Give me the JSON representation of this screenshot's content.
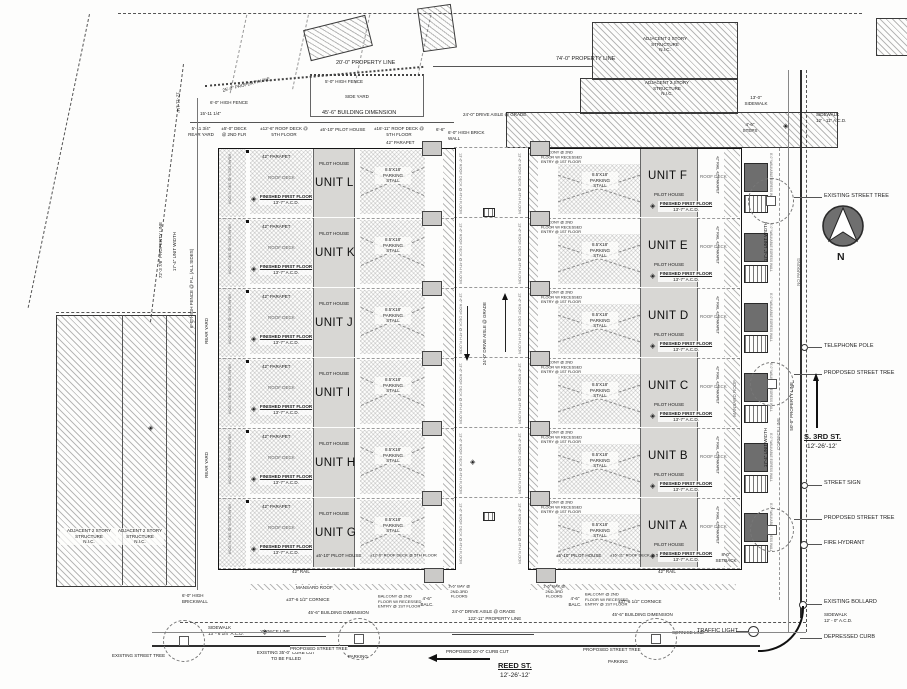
{
  "plan": {
    "sym": {
      "marker": "◈"
    },
    "compass": {
      "label": "N"
    },
    "streets": {
      "reed": {
        "name": "REED ST.",
        "lanes": "12'-26'-12'"
      },
      "third": {
        "name": "S. 3RD ST.",
        "lanes": "12'-26'-12'"
      }
    },
    "west_units": [
      "UNIT L",
      "UNIT K",
      "UNIT J",
      "UNIT I",
      "UNIT H",
      "UNIT G"
    ],
    "east_units": [
      "UNIT F",
      "UNIT E",
      "UNIT D",
      "UNIT C",
      "UNIT B",
      "UNIT A"
    ],
    "ua": {
      "parapet": "42\" PARAPET",
      "roof_deck": "ROOF DECK",
      "pilot_house": "PILOT HOUSE",
      "fff1": "FINISHED FIRST FLOOR",
      "fff2": "13'-7\" A.C.D.",
      "stall": "8.5'X18'\nPARKING\nSTALL",
      "balcony3": "BALCONY @ 2ND\nFLOOR W/ RECESSED\nENTRY @ 1ST FLOOR",
      "rail": "42\" RAIL",
      "rail_parapet": "42\" RAIL  42\" PARAPET",
      "rear_deck": "REAR DECK @ 2ND FLOOR",
      "roof_deck_4th": "13'-6\" ROOF DECK @ 4TH FLOOR",
      "egress": "8'-0\" WALKABLE EGRESS WALL"
    },
    "ann": {
      "prop_20": "20'-0\" PROPERTY LINE",
      "prop_74": "74'-0\" PROPERTY LINE",
      "prop_25": "25'-0\" PROPERTY LINE",
      "prop_72": "72'-3 7/8\" PROPERTY LINE",
      "prop_122": "122'-11\" PROPERTY LINE",
      "prop_50": "50'-0\" PROPERTY LINE",
      "prop_12": "12'-11 1/4\"",
      "fence_5": "5'-0\" HIGH FENCE",
      "fence_6": "6'-0\" HIGH FENCE",
      "fence_pl": "6'-0\" HIGH FENCE @ P.L. (ALL SIDES)",
      "side_yard": "SIDE YARD",
      "rear_yard": "REAR YARD",
      "dim_15": "15'-11 1/4\"",
      "dim_66": "6'-6\"",
      "bldg_dim": "45'-6\" BUILDING DIMENSION",
      "drive_aisle": "24'-0\" DRIVE AISLE @ GRADE",
      "rear_yard_dim": "5'-11 3/4\"\nREAR YARD",
      "deck_2nd": "±5'-0\" DECK\n@ 2ND FLR",
      "roofdeck_12": "±12'-6\" ROOF DECK @\n5TH FLOOR",
      "pilot_5": "±5'-10\" PILOT HOUSE",
      "roofdeck_16": "±16'-11\" ROOF DECK @\n5TH FLOOR",
      "brick_wall": "6'-0\" HIGH BRICK\nWALL",
      "brickwall2": "6'-0\" HIGH\nBRICKWALL",
      "sidewalk_13": "13'-0\"\nSIDEWALK",
      "sidewalk_12_11": "SIDEWALK\n12' - 11\" A.C.D.",
      "sidewalk_12_0": "SIDEWALK\n12' - 0\" A.C.D.",
      "sidewalk_13_6": "SIDEWALK\n13' - 6 1/4\" A.C.D.",
      "steps_46": "4'-6\"\nSTEPS",
      "existing_tree": "EXISTING STREET TREE",
      "proposed_tree": "PROPOSED STREET TREE",
      "telephone_pole": "TELEPHONE POLE",
      "street_sign": "STREET SIGN",
      "fire_hydrant": "FIRE HYDRANT",
      "bollard": "EXISTING BOLLARD",
      "depressed_curb": "DEPRESSED CURB",
      "traffic_light": "TRAFFIC LIGHT",
      "parking": "PARKING",
      "cornice_37": "±37'-6 1/2\" CORNICE",
      "cornice_line": "CORNICE LINE",
      "curb_cut_ex": "EXISTING 35'-0\" CURB CUT\nTO BE FILLED",
      "curb_cut_prop": "PROPOSED 20'-0\" CURB CUT",
      "bay_16": "1'-6\" BAY @\n2ND-3RD\nFLOORS",
      "balc_46": "4'-6\"\nBALC.",
      "mansard": "MANSARD ROOF",
      "setback_8": "8'-0\"\nSETBACK",
      "no_parking": "NO PARKING",
      "unit_width": "17'-4\" UNIT WIDTH"
    },
    "adjacent": {
      "top_a": "ADJACENT 3 STORY\nSTRUCTURE\nN.I.C.",
      "top_b": "ADJACENT 2 STORY\nSTRUCTURE\nN.I.C.",
      "left_a": "ADJACENT 2 STORY\nSTRUCTURE\nN.I.C.",
      "left_b": "ADJACENT 2 STORY\nSTRUCTURE\nN.I.C."
    }
  }
}
